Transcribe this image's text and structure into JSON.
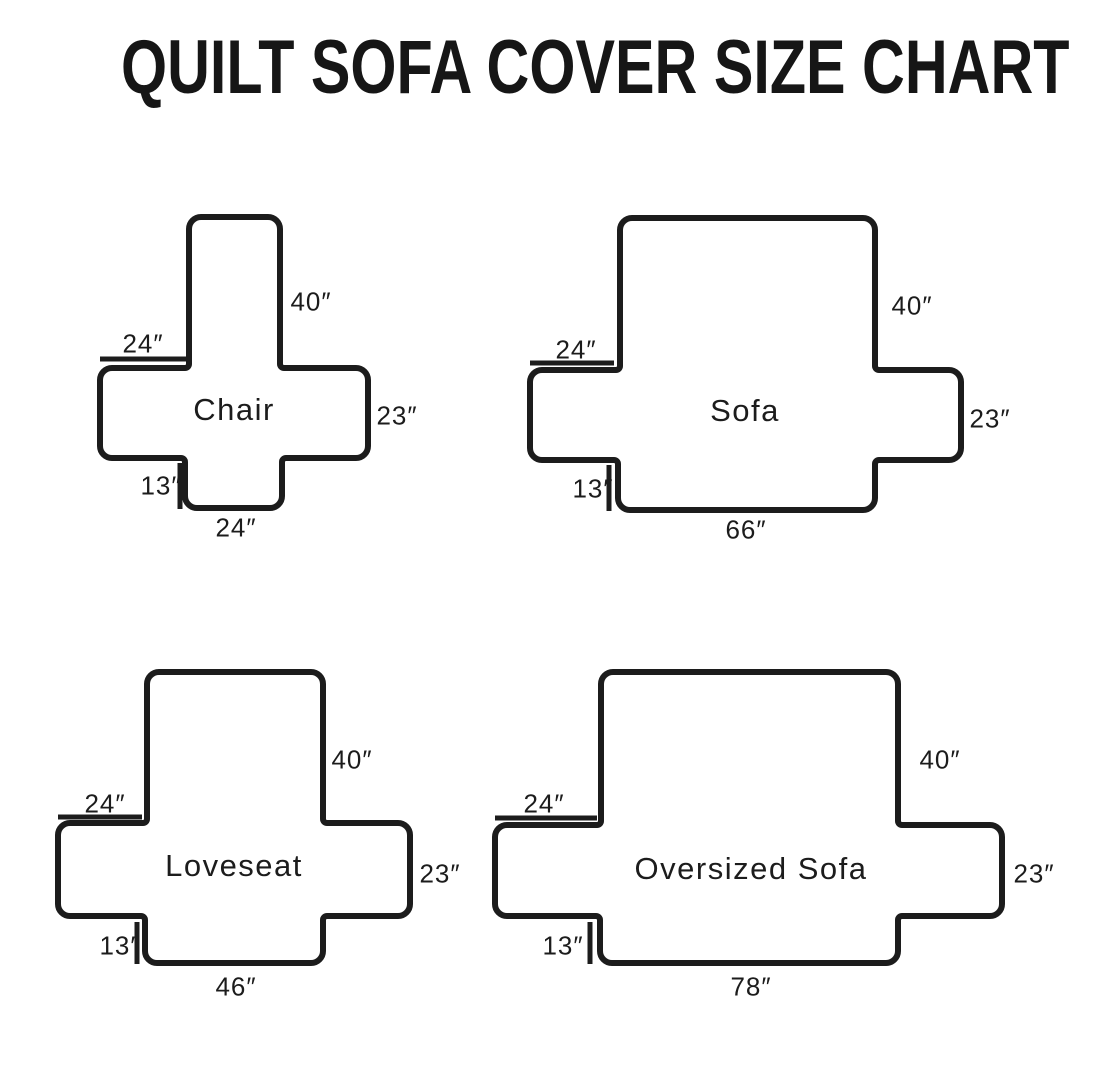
{
  "title": "QUILT SOFA COVER SIZE CHART",
  "diagrams": {
    "chair": {
      "name": "Chair",
      "back_height": "40″",
      "arm_width": "24″",
      "side_height": "23″",
      "skirt_height": "13″",
      "seat_width": "24″"
    },
    "sofa": {
      "name": "Sofa",
      "back_height": "40″",
      "arm_width": "24″",
      "side_height": "23″",
      "skirt_height": "13″",
      "seat_width": "66″"
    },
    "loveseat": {
      "name": "Loveseat",
      "back_height": "40″",
      "arm_width": "24″",
      "side_height": "23″",
      "skirt_height": "13″",
      "seat_width": "46″"
    },
    "oversized_sofa": {
      "name": "Oversized Sofa",
      "back_height": "40″",
      "arm_width": "24″",
      "side_height": "23″",
      "skirt_height": "13″",
      "seat_width": "78″"
    }
  }
}
